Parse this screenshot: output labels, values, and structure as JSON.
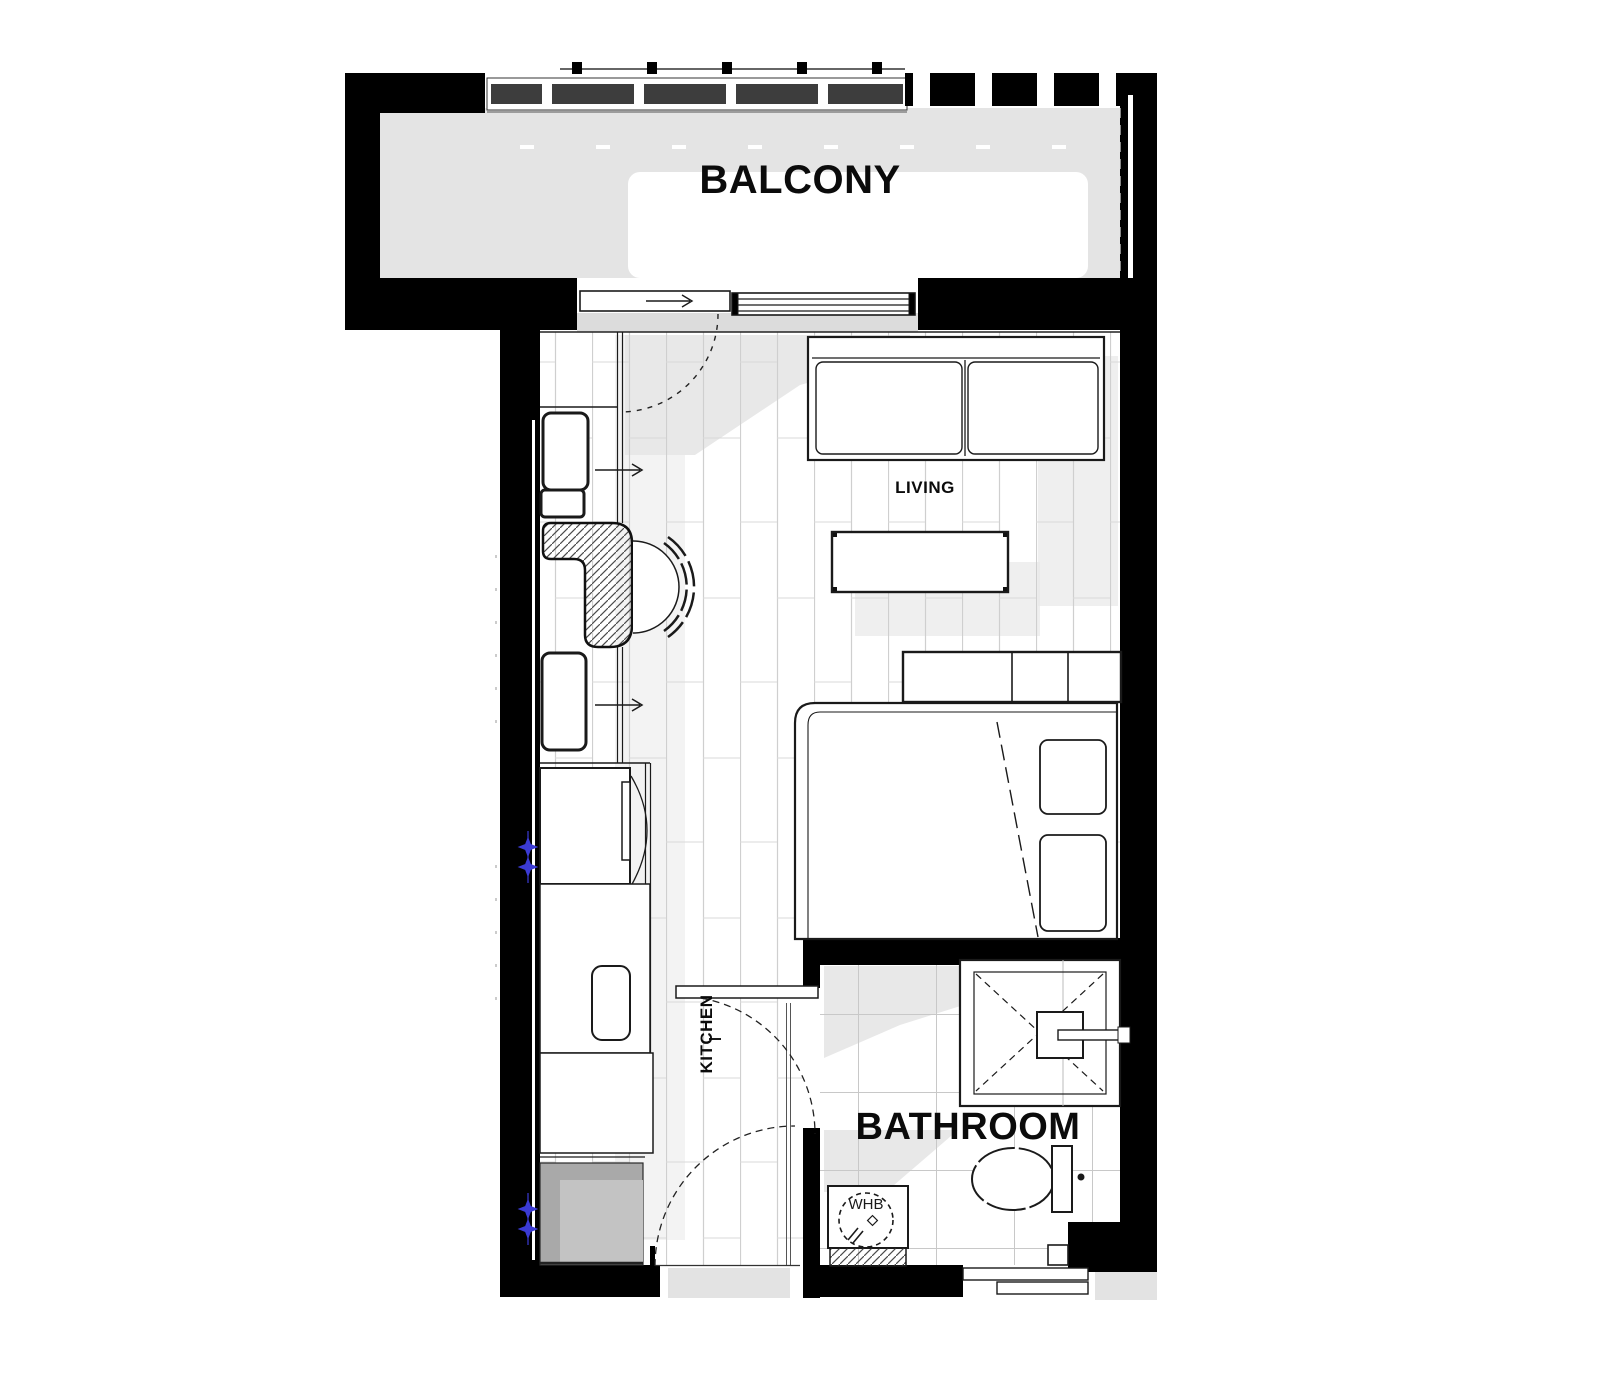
{
  "plan": {
    "title": "Studio apartment floor plan",
    "labels": {
      "balcony": "BALCONY",
      "living": "LIVING",
      "kitchen": "KITCHEN",
      "bathroom": "BATHROOM",
      "whb": "WHB"
    },
    "rooms": [
      "BALCONY",
      "LIVING",
      "KITCHEN",
      "BATHROOM"
    ],
    "colors": {
      "wall_black": "#000000",
      "balcony_floor_gray": "#e4e4e4",
      "threshold_gray": "#dcdcdc",
      "shadow_gray": "#e8e8e8",
      "rail_dark_gray": "#3d3d3d",
      "laundry_dark_gray": "#a9a9a9",
      "laundry_light_gray": "#c3c3c3",
      "line_dark": "#1a1a1a",
      "floor_line_gray": "#cfcfcf",
      "tile_line_gray": "#c8c8c8",
      "service_marker_blue": "#3b3bd4"
    }
  }
}
